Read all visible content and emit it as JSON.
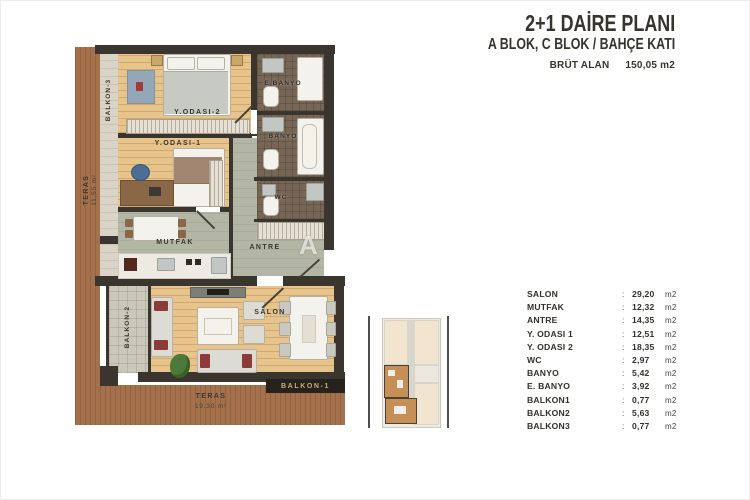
{
  "header": {
    "title": "2+1 DAİRE PLANI",
    "subtitle": "A BLOK, C BLOK / BAHÇE KATI",
    "gross_area_label": "BRÜT ALAN",
    "gross_area_value": "150,05 m2"
  },
  "area_table": {
    "separator": ":",
    "unit": "m2",
    "rows": [
      {
        "label": "SALON",
        "value": "29,20"
      },
      {
        "label": "MUTFAK",
        "value": "12,32"
      },
      {
        "label": "ANTRE",
        "value": "14,35"
      },
      {
        "label": "Y. ODASI 1",
        "value": "12,51"
      },
      {
        "label": "Y. ODASI 2",
        "value": "18,35"
      },
      {
        "label": "WC",
        "value": "2,97"
      },
      {
        "label": "BANYO",
        "value": "5,42"
      },
      {
        "label": "E. BANYO",
        "value": "3,92"
      },
      {
        "label": "BALKON1",
        "value": "0,77"
      },
      {
        "label": "BALKON2",
        "value": "5,63"
      },
      {
        "label": "BALKON3",
        "value": "0,77"
      }
    ]
  },
  "plan": {
    "rooms": {
      "y_odasi_2": "Y.ODASI-2",
      "y_odasi_1": "Y.ODASI-1",
      "e_banyo": "E.BANYO",
      "banyo": "BANYO",
      "wc": "WC",
      "mutfak": "MUTFAK",
      "antre": "ANTRE",
      "salon": "SALON",
      "balkon_1": "BALKON-1",
      "balkon_2": "BALKON-2",
      "balkon_3": "BALKON-3"
    },
    "teras_left": {
      "label": "TERAS",
      "area": "11,55 m²"
    },
    "teras_bottom": {
      "label": "TERAS",
      "area": "19.30 m²"
    },
    "watermark": "A"
  },
  "colors": {
    "wall": "#3a362f",
    "wood_deck": "#a5714d",
    "room_wood": "#e6c48b",
    "wet_floor": "#776555",
    "service_floor": "#b3b5a5",
    "accent_red": "#8d3a3a",
    "keyplan_highlight": "#c68f55"
  }
}
